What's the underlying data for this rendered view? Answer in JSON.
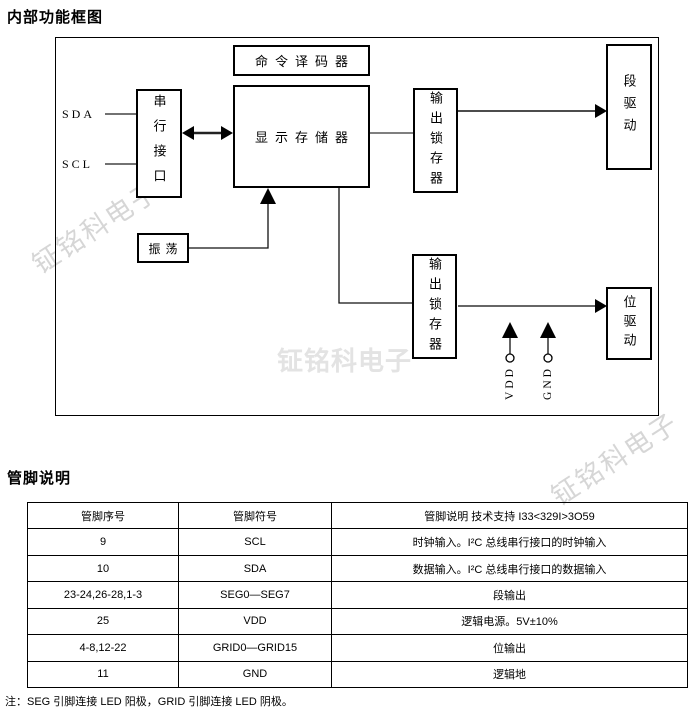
{
  "page": {
    "title_block_diagram": "内部功能框图",
    "title_pin_desc": "管脚说明",
    "note": "注：SEG 引脚连接 LED 阳极，GRID 引脚连接 LED 阴极。",
    "watermark_text": "钲铭科电子"
  },
  "diagram": {
    "blocks": {
      "command_decoder": "命令译码器",
      "serial_interface": "串行接口",
      "display_memory": "显示存储器",
      "oscillator": "振荡",
      "output_latch_top": "输出锁存器",
      "output_latch_bottom": "输出锁存器",
      "segment_driver": "段驱动",
      "bit_driver": "位驱动"
    },
    "pins": {
      "sda": "SDA",
      "scl": "SCL",
      "vdd": "VDD",
      "gnd": "GND"
    }
  },
  "pin_table": {
    "headers": [
      "管脚序号",
      "管脚符号",
      "管脚说明 技术支持 I33<329I>3O59"
    ],
    "rows": [
      {
        "no": "9",
        "symbol": "SCL",
        "desc": "时钟输入。I²C 总线串行接口的时钟输入"
      },
      {
        "no": "10",
        "symbol": "SDA",
        "desc": "数据输入。I²C 总线串行接口的数据输入"
      },
      {
        "no": "23-24,26-28,1-3",
        "symbol": "SEG0—SEG7",
        "desc": "段输出"
      },
      {
        "no": "25",
        "symbol": "VDD",
        "desc": "逻辑电源。5V±10%"
      },
      {
        "no": "4-8,12-22",
        "symbol": "GRID0—GRID15",
        "desc": "位输出"
      },
      {
        "no": "11",
        "symbol": "GND",
        "desc": "逻辑地"
      }
    ]
  },
  "colors": {
    "line": "#000000",
    "watermark": "#d6d6d6"
  }
}
